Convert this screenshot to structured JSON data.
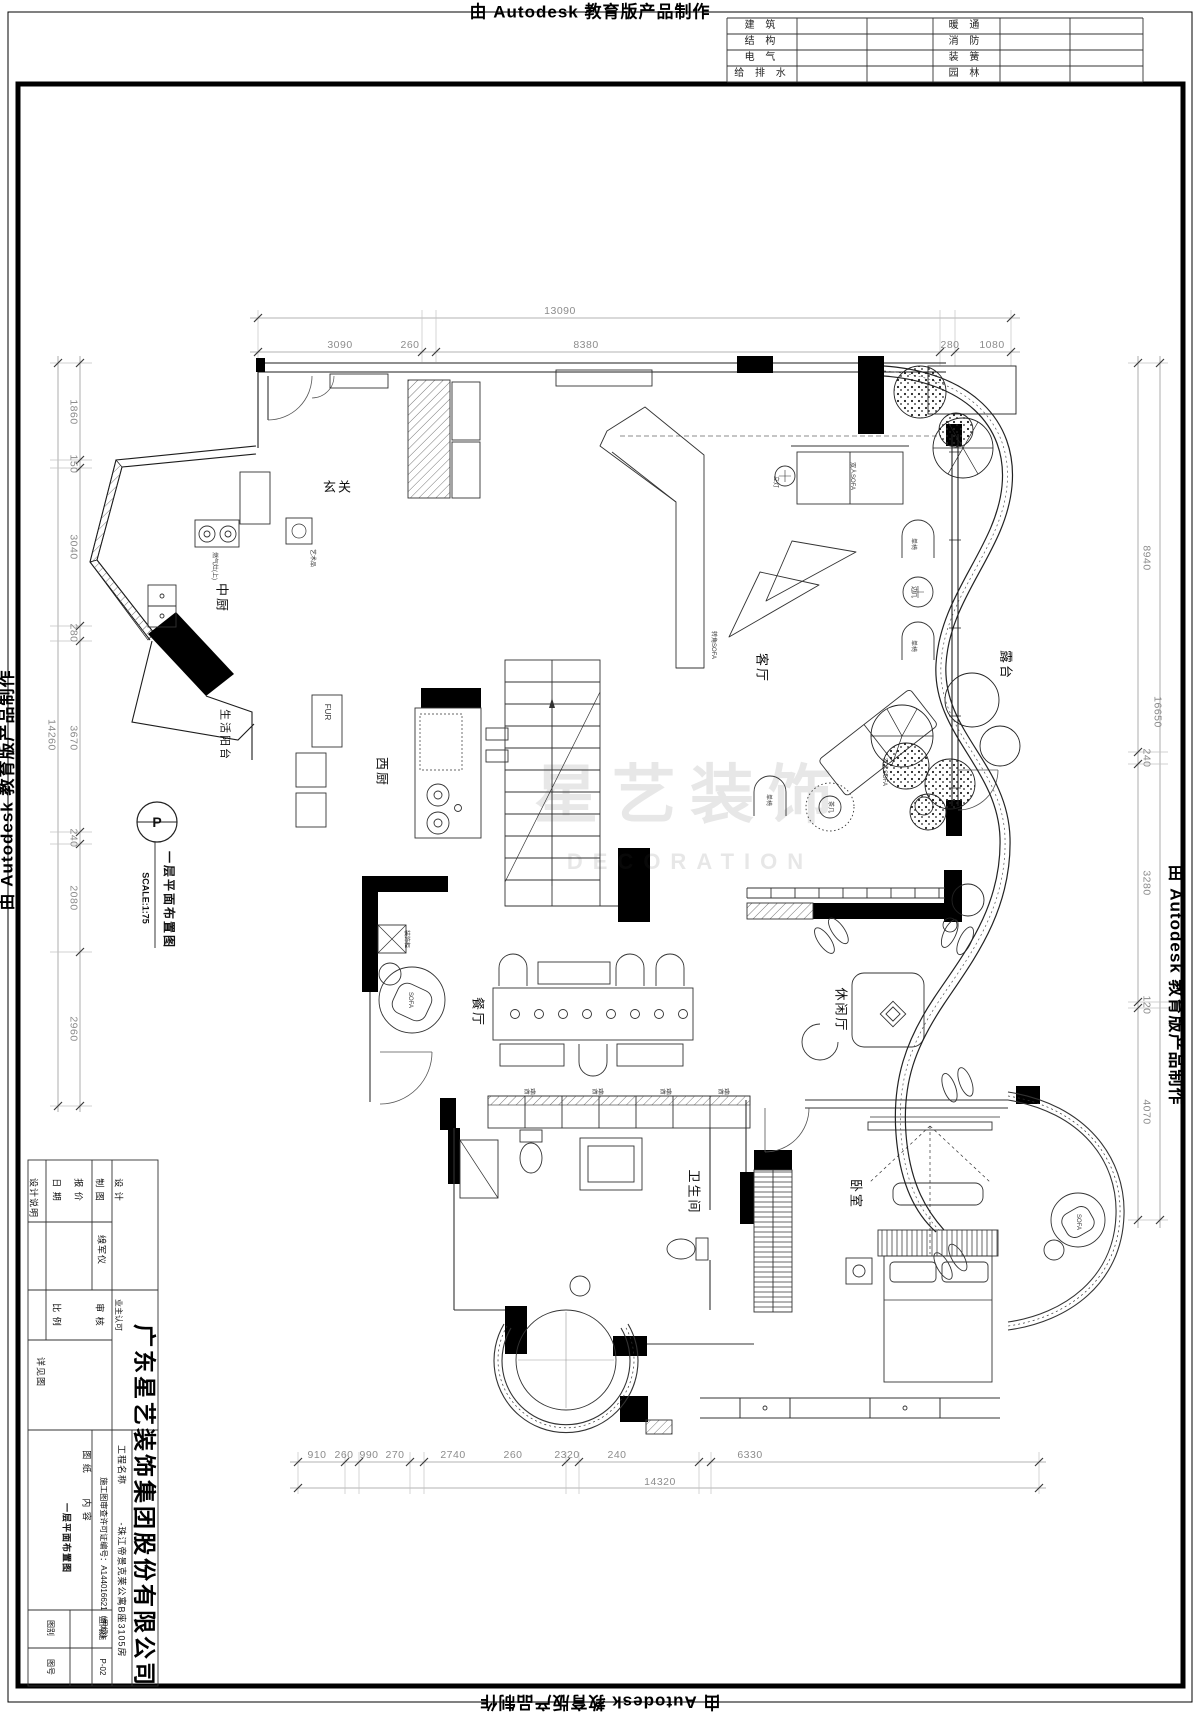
{
  "banner": {
    "text": "由 Autodesk 教育版产品制作"
  },
  "discipline_table": {
    "rows": [
      {
        "left": "建  筑",
        "right": "暖  通"
      },
      {
        "left": "结  构",
        "right": "消  防"
      },
      {
        "left": "电  气",
        "right": "装  簧"
      },
      {
        "left": "给 排 水",
        "right": "园  林"
      }
    ]
  },
  "rooms": {
    "entry": "玄关",
    "mid_kitchen": "中厨",
    "service_balcony": "生活阳台",
    "west_kitchen": "西厨",
    "living": "客厅",
    "terrace": "露台",
    "dining": "餐厅",
    "leisure": "休闲厅",
    "bath": "卫生间",
    "bedroom": "卧室"
  },
  "stamp": {
    "mark": "P",
    "title": "一层平面布置图",
    "scale": "SCALE:1:75"
  },
  "watermark": {
    "cn": "星艺装饰",
    "en": "DECORATION"
  },
  "annotations": {
    "art": "艺术品",
    "stove": "燃气灶(上)",
    "fur": "FUR",
    "floor_lamp": "立灯",
    "sofa_double": "双人SOFA",
    "sofa_corner": "转角SOFA",
    "chair_single": "单椅",
    "side_table": "边几",
    "tea_table": "茶几",
    "sofa_round": "SOFA",
    "deco_cabinet": "装饰柜",
    "dining_cabinet": "餐柜"
  },
  "dims": {
    "top": {
      "total": "13090",
      "segments": [
        "3090",
        "260",
        "8380",
        "280",
        "1080"
      ]
    },
    "bottom": {
      "total": "14320",
      "segments": [
        "910",
        "260",
        "990",
        "270",
        "2740",
        "260",
        "2320",
        "240",
        "6330"
      ]
    },
    "left": {
      "total": "14260",
      "segments": [
        "1860",
        "150",
        "3040",
        "280",
        "3670",
        "240",
        "2080",
        "2960"
      ]
    },
    "right": {
      "total": "16650",
      "segments": [
        "8940",
        "240",
        "3280",
        "120",
        "4070"
      ]
    }
  },
  "titleblock": {
    "note": "设计说明",
    "design_label": "设 计",
    "draft_label": "制 图",
    "quote_label": "报 价",
    "date_label": "日 期",
    "designer": "缐军仪",
    "owner_label": "业主认可",
    "review_label": "审 核",
    "scale_label": "比 例",
    "detail_label": "详见图",
    "company": "广东星艺装饰集团股份有限公司",
    "project_label": "工程名称",
    "project_value": "-珠江帝景克莱公寓B座3105房",
    "permit": "施工图审查许可证编号：A144016621（甲级）",
    "sheet_label": "图 纸",
    "content_label": "内 容",
    "sheet_content": "一层平面布置图",
    "category_label": "图别",
    "category_value": "室内施",
    "number_label": "图号",
    "number_value": "P-02"
  }
}
